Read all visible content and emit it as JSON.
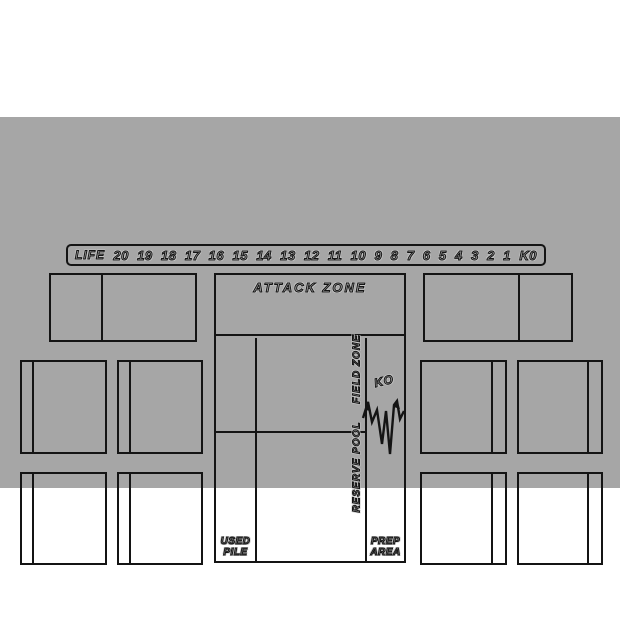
{
  "colors": {
    "page_bg": "#ffffff",
    "mat": "#a6a6a6",
    "line": "#141414"
  },
  "life_track": {
    "label": "LIFE",
    "values": [
      "20",
      "19",
      "18",
      "17",
      "16",
      "15",
      "14",
      "13",
      "12",
      "11",
      "10",
      "9",
      "8",
      "7",
      "6",
      "5",
      "4",
      "3",
      "2",
      "1",
      "K0"
    ]
  },
  "zones": {
    "attack": {
      "label": "ATTACK ZONE"
    },
    "field": {
      "label": "FIELD ZONE"
    },
    "reserve": {
      "label": "RESERVE POOL"
    },
    "ko": {
      "label": "KO"
    },
    "used_pile": {
      "line1": "USED",
      "line2": "PILE"
    },
    "prep_area": {
      "line1": "PREP",
      "line2": "AREA"
    }
  }
}
